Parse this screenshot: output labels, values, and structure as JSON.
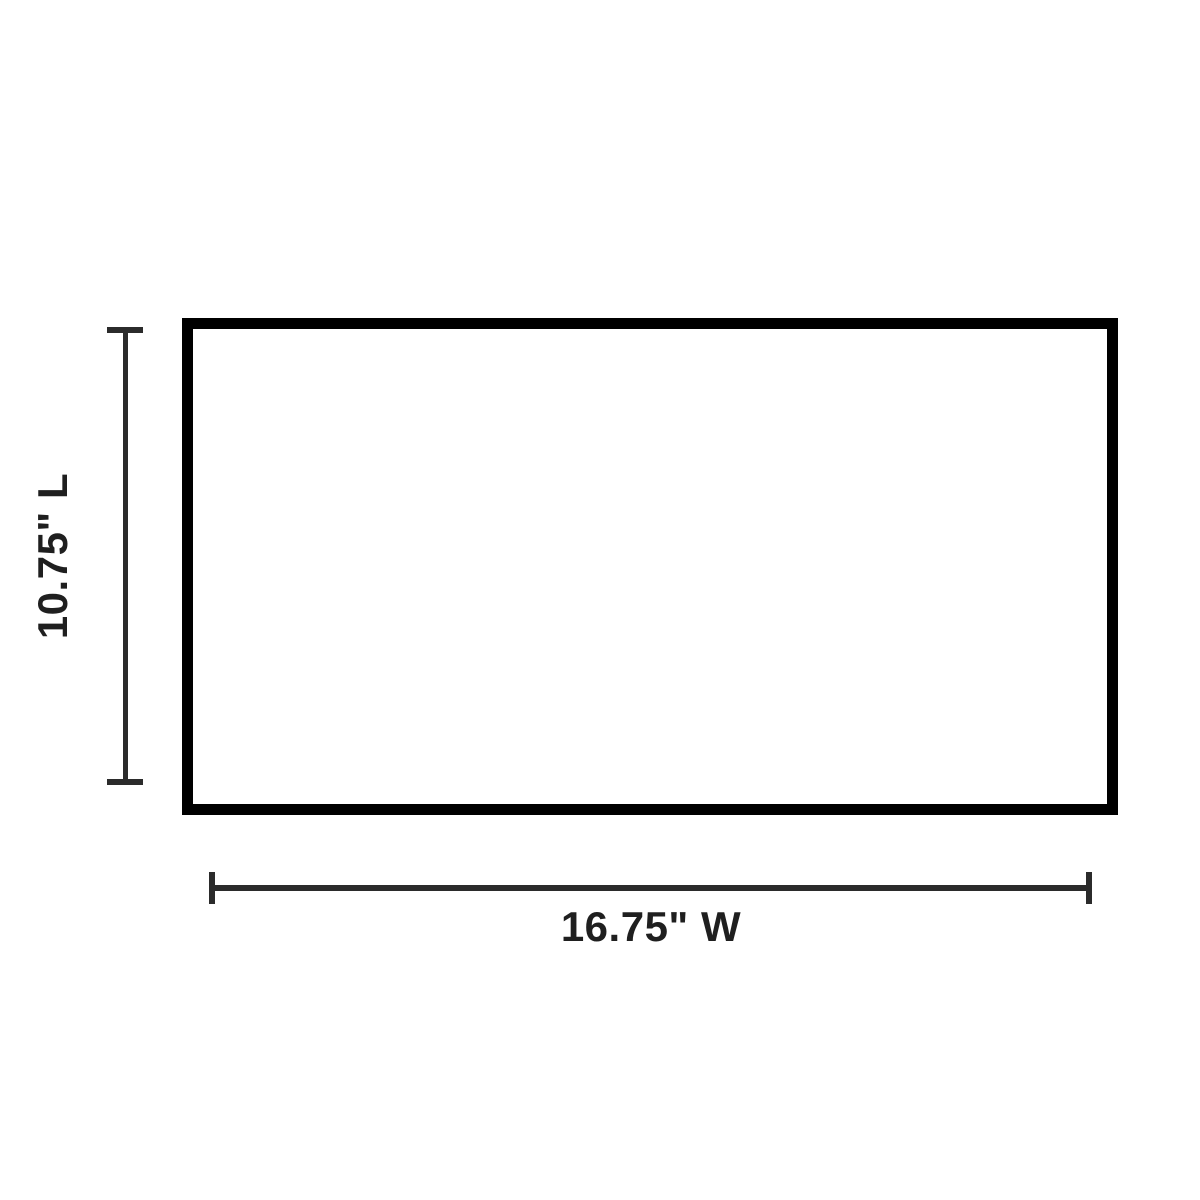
{
  "diagram": {
    "type": "product-dimension-diagram",
    "shape": "rectangle",
    "length_label": "10.75\" L",
    "width_label": "16.75\" W"
  },
  "colors": {
    "background": "#ffffff",
    "rectangle_outline": "#000000",
    "dimension_line": "#2b2b2b",
    "label_text": "#1f1f1f"
  }
}
